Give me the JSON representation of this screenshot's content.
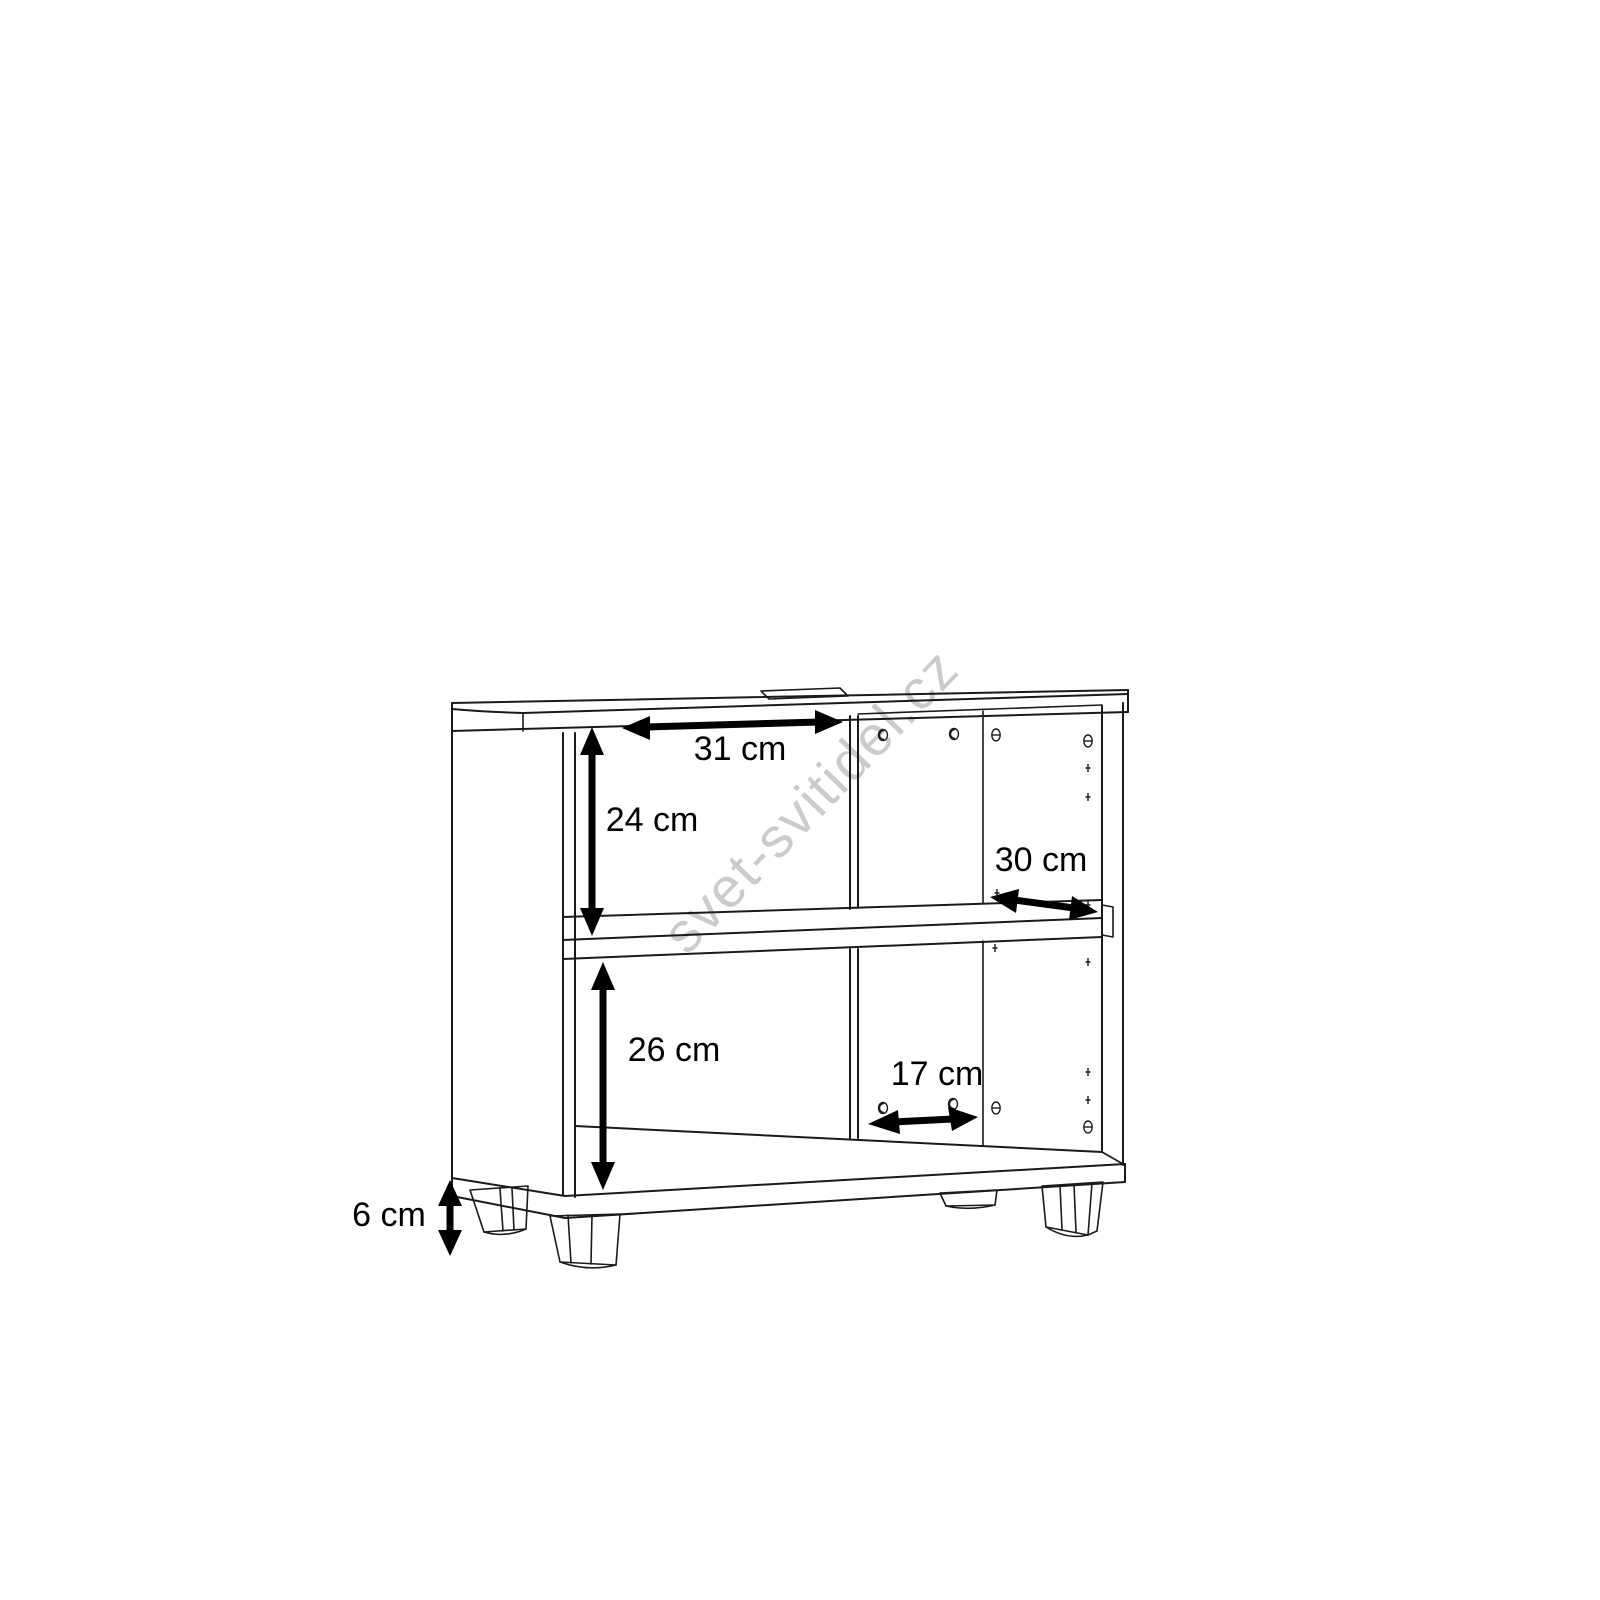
{
  "diagram": {
    "type": "furniture-dimension-drawing",
    "line_color": "#1a1a1a",
    "background_color": "#ffffff",
    "notch_fill_color": "#bdbdbd"
  },
  "watermark": {
    "text": "svet-svitidel.cz",
    "color": "#cbcbcb",
    "angle_deg": -46
  },
  "dimensions": [
    {
      "id": "top-inner-width",
      "label": "31 cm",
      "value": 31,
      "unit": "cm"
    },
    {
      "id": "upper-compartment-height",
      "label": "24 cm",
      "value": 24,
      "unit": "cm"
    },
    {
      "id": "shelf-depth",
      "label": "30 cm",
      "value": 30,
      "unit": "cm"
    },
    {
      "id": "lower-compartment-height",
      "label": "26 cm",
      "value": 26,
      "unit": "cm"
    },
    {
      "id": "lower-back-width",
      "label": "17 cm",
      "value": 17,
      "unit": "cm"
    },
    {
      "id": "leg-height",
      "label": "6 cm",
      "value": 6,
      "unit": "cm"
    }
  ]
}
